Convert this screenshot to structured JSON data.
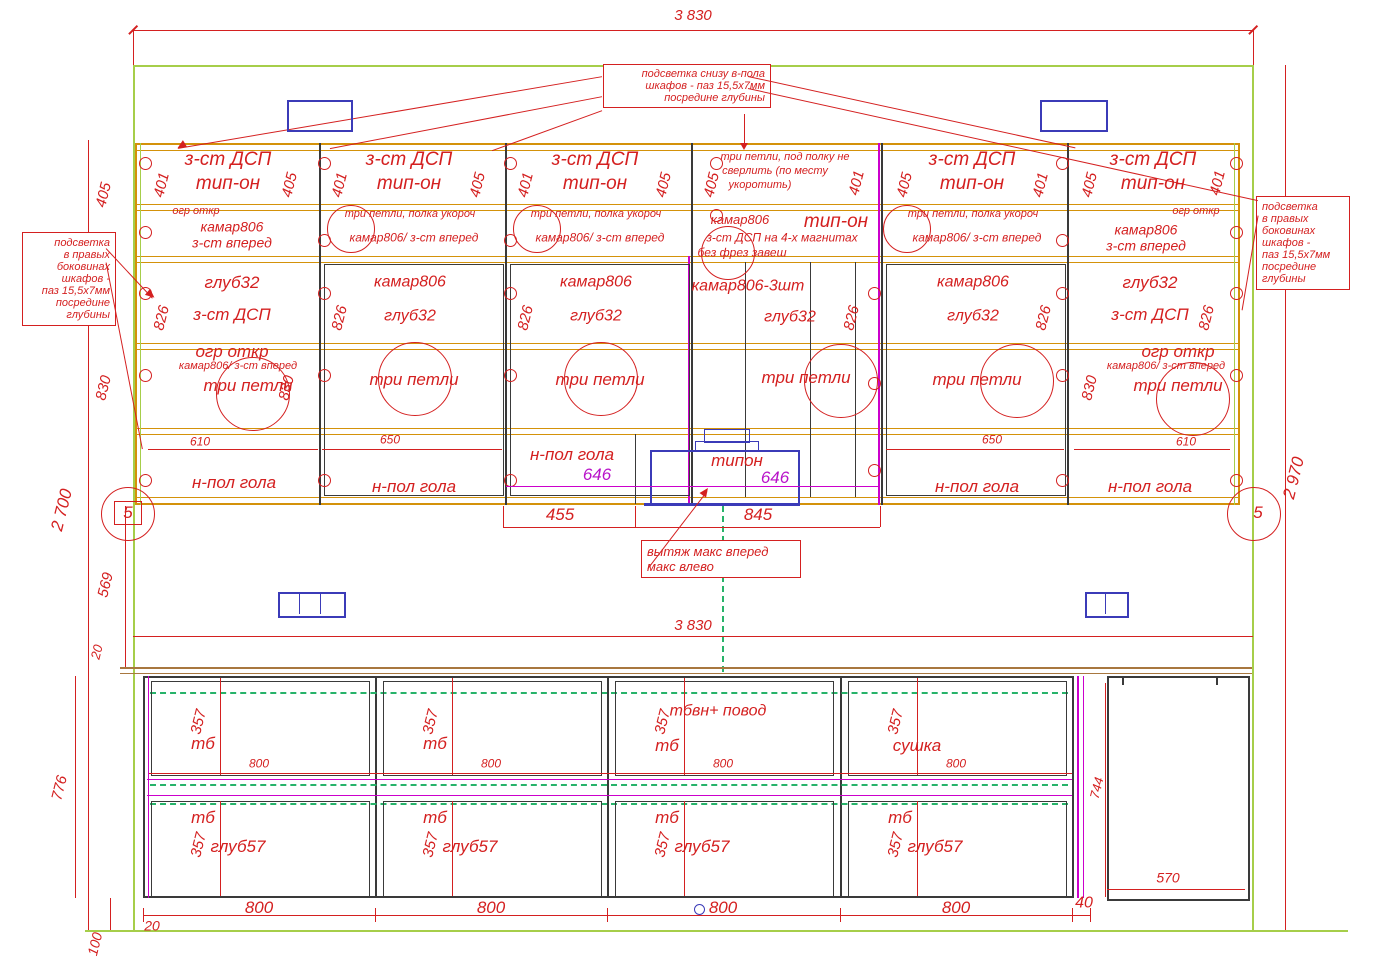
{
  "dims": {
    "w_top": "3 830",
    "w_low": "3 830",
    "h_left": "2 700",
    "h_right": "2 970",
    "gap": "569",
    "top20": "20",
    "low_h": "776",
    "plinth": "100",
    "plinth20": "20",
    "out405": "405",
    "out830": "830",
    "shelf455": "455",
    "hood845": "845",
    "gap40": "40",
    "right744": "744",
    "right570": "570"
  },
  "notes": {
    "top": [
      "подсветка снизу в-пола",
      "шкафов - паз 15,5х7мм",
      "посредине глубины"
    ],
    "left": [
      "подсветка",
      "в правых",
      "боковинах",
      "шкафов -",
      "паз 15,5х7мм",
      "посредине",
      "глубины"
    ],
    "right": [
      "подсветка",
      "в правых",
      "боковинах",
      "шкафов -",
      "паз 15,5х7мм",
      "посредине",
      "глубины"
    ],
    "hood": [
      "вытяж макс вперед",
      "макс влево"
    ]
  },
  "markers": {
    "l": "5",
    "r": "5"
  },
  "hood": {
    "label": "типон",
    "lvl_left": "646",
    "lvl_right": "646"
  },
  "cabs": [
    {
      "door1": "з-ст ДСП",
      "door2": "тип-он",
      "dimL": "401",
      "dimR": "405",
      "dim826": "826",
      "dim830": "830",
      "noteA": "огр откр",
      "noteB": "камар806",
      "noteC": "з-ст вперед",
      "midA": "глуб32",
      "midB": "з-ст ДСП",
      "hingeA": "огр откр",
      "hingeB": "камар806/ з-ст вперед",
      "hingeC": "три петли",
      "shelf_dim": "610",
      "shelf": "н-пол гола"
    },
    {
      "door1": "з-ст ДСП",
      "door2": "тип-он",
      "dimL": "401",
      "dimR": "405",
      "dim826": "826",
      "noteA": "три петли, полка укороч",
      "noteB": "камар806/ з-ст вперед",
      "midA": "камар806",
      "midB": "глуб32",
      "hingeC": "три петли",
      "shelf_dim": "650",
      "shelf": "н-пол гола"
    },
    {
      "door1": "з-ст ДСП",
      "door2": "тип-он",
      "dimL": "401",
      "dimR": "405",
      "dim826": "826",
      "noteA": "три петли, полка укороч",
      "noteB": "камар806/ з-ст вперед",
      "midA": "камар806",
      "midB": "глуб32",
      "hingeC": "три петли",
      "shelf": "н-пол гола",
      "level": "646"
    },
    {
      "topnote": [
        "три петли, под полку не",
        "сверлить (по месту",
        "укоротить)"
      ],
      "dimL": "405",
      "dimR": "401",
      "dim826": "826",
      "noteA": "камар806",
      "noteB": "з-ст ДСП на 4-х магнитах",
      "noteC": "без фрез завеш",
      "tip": "тип-он",
      "midA": "камар806-3шт",
      "midB": "глуб32",
      "hingeC": "три петли"
    },
    {
      "door1": "з-ст ДСП",
      "door2": "тип-он",
      "dimL": "405",
      "dimR": "401",
      "dim826": "826",
      "noteA": "три петли, полка укороч",
      "noteB": "камар806/ з-ст вперед",
      "midA": "камар806",
      "midB": "глуб32",
      "hingeC": "три петли",
      "shelf_dim": "650",
      "shelf": "н-пол гола"
    },
    {
      "door1": "з-ст ДСП",
      "door2": "тип-он",
      "dimL": "405",
      "dimR": "401",
      "dim826": "826",
      "dim830": "830",
      "noteA": "огр откр",
      "noteB": "камар806",
      "noteC": "з-ст вперед",
      "midA": "глуб32",
      "midB": "з-ст ДСП",
      "hingeA": "огр откр",
      "hingeB": "камар806/ з-ст вперед",
      "hingeC": "три петли",
      "shelf_dim": "610",
      "shelf": "н-пол гола"
    }
  ],
  "lower": {
    "sections": [
      {
        "d1": "357",
        "top": "тб",
        "w": "800",
        "d2": "357",
        "b1": "тб",
        "b2": "глуб57",
        "bw": "800"
      },
      {
        "d1": "357",
        "top": "тб",
        "w": "800",
        "d2": "357",
        "b1": "тб",
        "b2": "глуб57",
        "bw": "800"
      },
      {
        "extra": "тбвн+ повод",
        "d1": "357",
        "top": "тб",
        "w": "800",
        "d2": "357",
        "b1": "тб",
        "b2": "глуб57",
        "bw": "800"
      },
      {
        "d1": "357",
        "top": "сушка",
        "w": "800",
        "d2": "357",
        "b1": "тб",
        "b2": "глуб57",
        "bw": "800"
      }
    ]
  }
}
